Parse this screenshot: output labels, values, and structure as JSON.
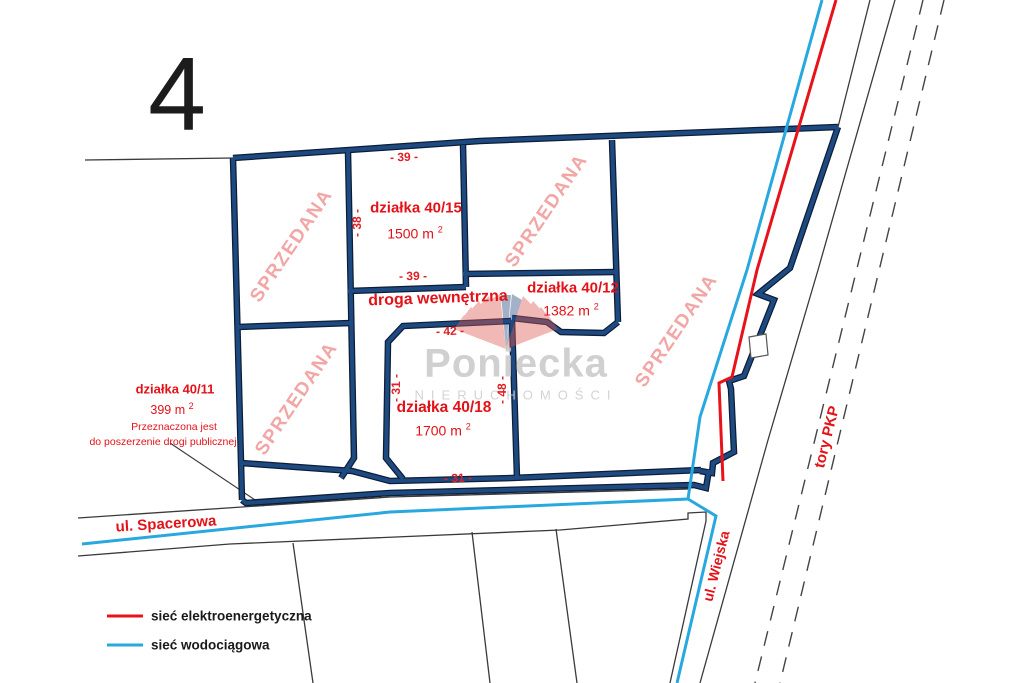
{
  "sheet_number": "4",
  "watermark": {
    "brand": "Poniecka",
    "subtitle": "NIERUCHOMOŚCI"
  },
  "plots": [
    {
      "name": "działka 40/15",
      "area": "1500 m",
      "area_sup": "2"
    },
    {
      "name": "działka 40/12",
      "area": "1382 m",
      "area_sup": "2"
    },
    {
      "name": "działka 40/18",
      "area": "1700 m",
      "area_sup": "2"
    },
    {
      "name": "działka 40/11",
      "area": "399 m",
      "area_sup": "2",
      "note_line1": "Przeznaczona jest",
      "note_line2": "do poszerzenie drogi publicznej"
    }
  ],
  "sold_labels": [
    "SPRZEDANA",
    "SPRZEDANA",
    "SPRZEDANA",
    "SPRZEDANA"
  ],
  "internal_road_label": "droga wewnętrzna",
  "streets": {
    "spacerowa": "ul. Spacerowa",
    "wiejska": "ul. Wiejska",
    "railway": "tory PKP"
  },
  "dimensions": [
    "- 39 -",
    "- 38 -",
    "- 39 -",
    "- 42 -",
    "- 31 -",
    "- 48 -",
    "- 31 -"
  ],
  "legend": [
    {
      "label": "sieć elektroenergetyczna",
      "color": "#e8131a"
    },
    {
      "label": "sieć wodociągowa",
      "color": "#29a8e0"
    }
  ],
  "colors": {
    "boundary_navy": "#1e4a82",
    "boundary_edge": "#0d1d36",
    "power_red": "#e8131a",
    "water_blue": "#29a8e0",
    "label_red": "#e31219",
    "sold_pink": "#f2a6a6",
    "watermark_gray": "#c8c8c8"
  }
}
